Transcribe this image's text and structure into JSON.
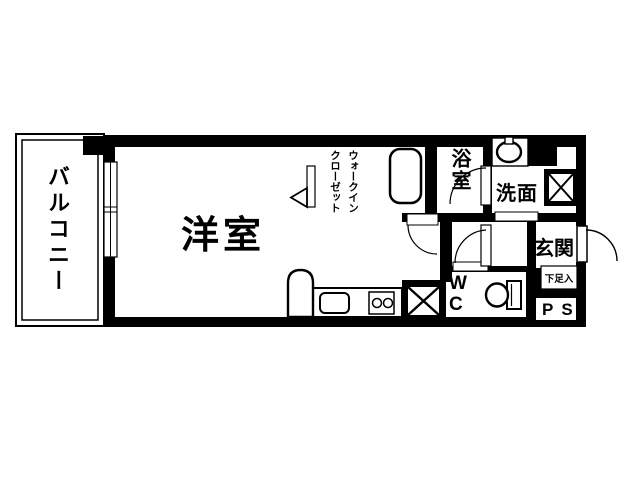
{
  "plan": {
    "type": "apartment-floor-plan",
    "style": "1K japanese floor plan, black walls on white background"
  },
  "labels": {
    "balcony": "バルコニー",
    "western_room": "洋室",
    "walk_in_closet_col_right": "ウォークイン",
    "walk_in_closet_col_left": "クローゼット",
    "bathroom": "浴室",
    "washroom": "洗面",
    "entrance": "玄関",
    "wc": "W\nC",
    "shoe_storage": "下足入",
    "pipe_space": "PS"
  },
  "fixtures": [
    "bathtub",
    "wash-basin",
    "washing-machine-space-cross",
    "toilet",
    "kitchen-counter",
    "kitchen-sink",
    "two-burner-stove",
    "refrigerator-space",
    "laundry-space-cross",
    "window",
    "door-swing-arcs",
    "front-door"
  ],
  "colors": {
    "line": "#000000",
    "floor": "#ffffff"
  }
}
